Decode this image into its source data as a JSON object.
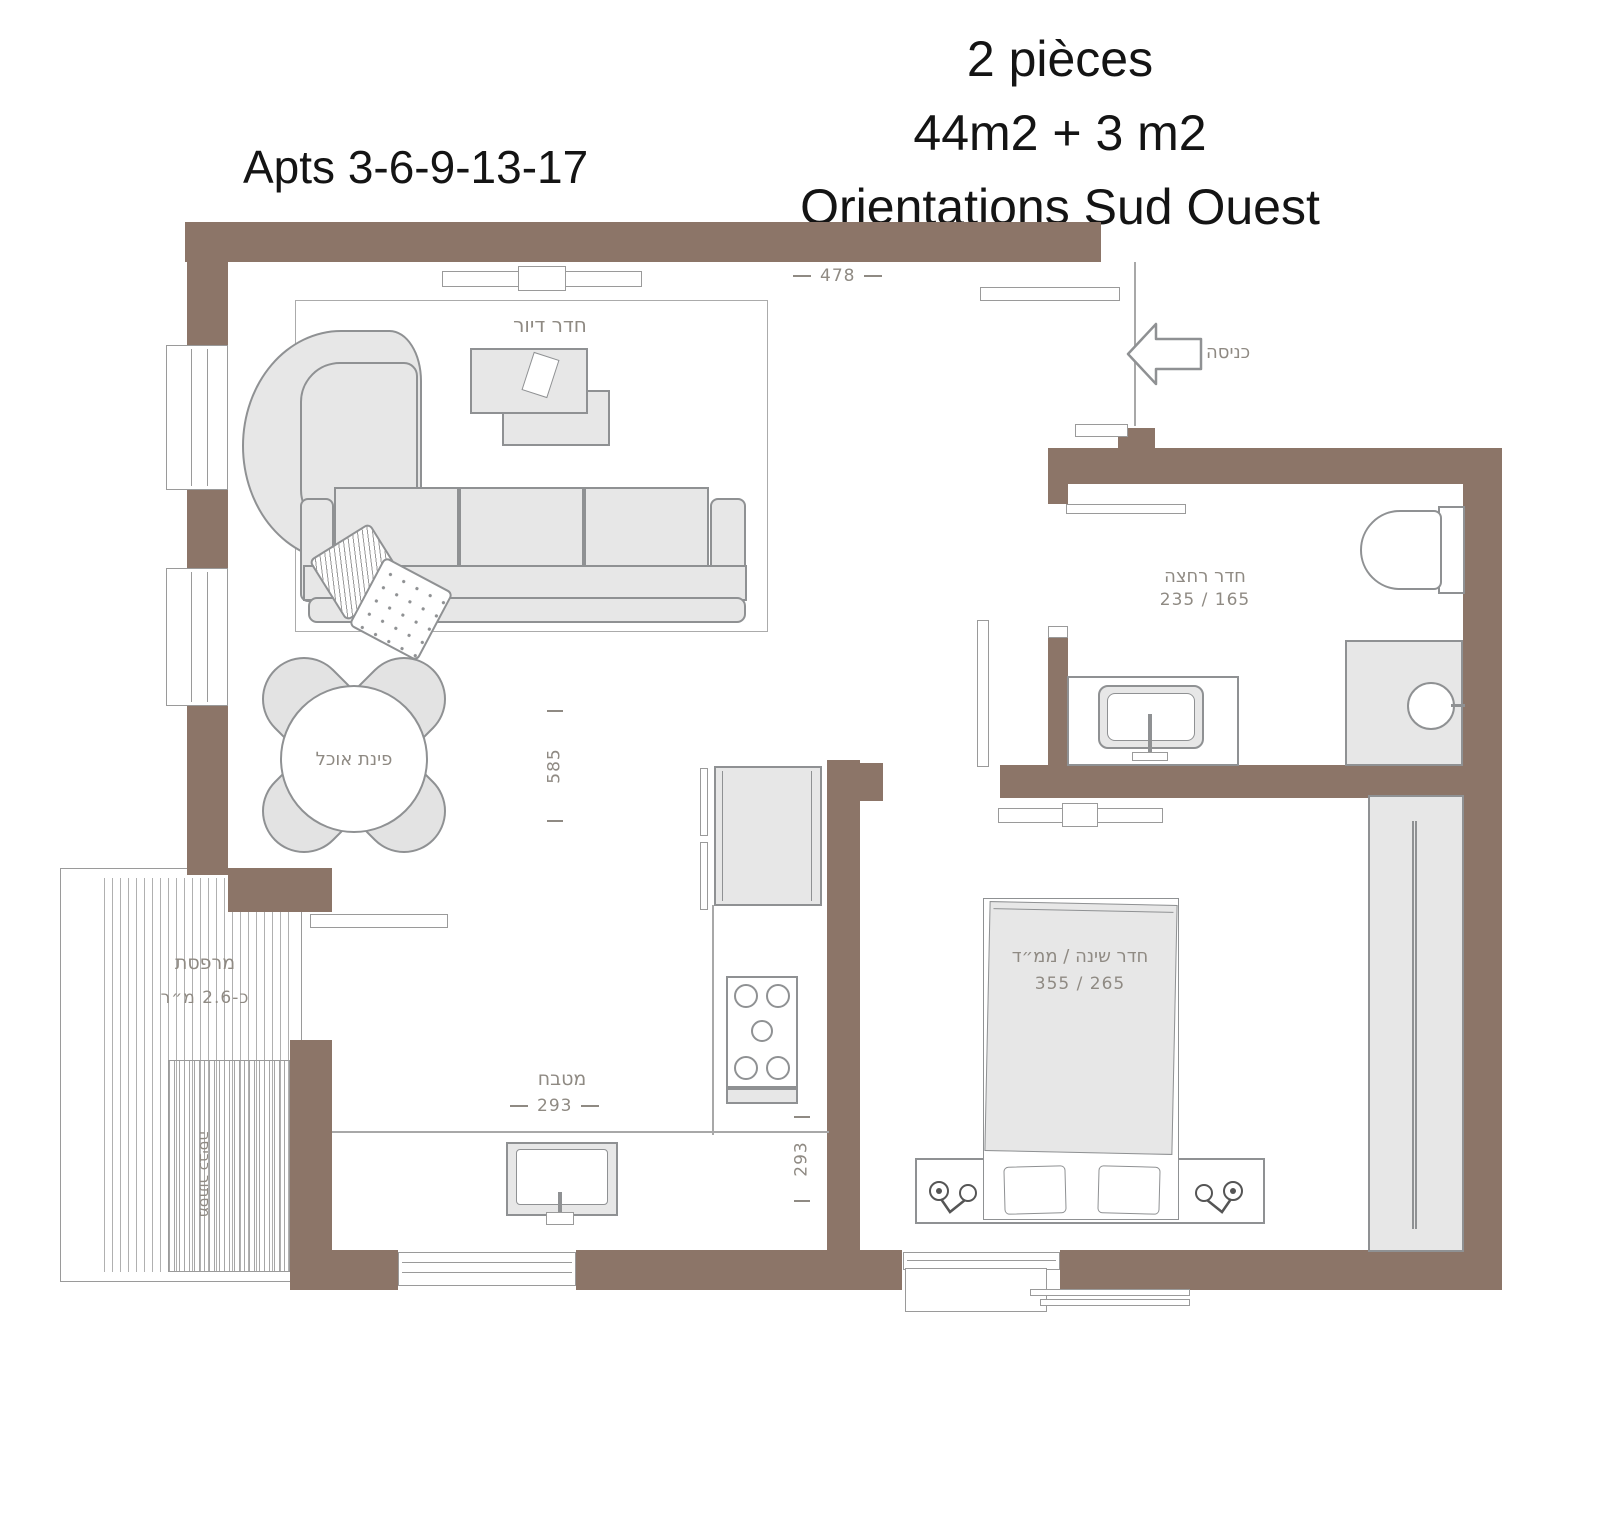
{
  "titles": {
    "apts": "Apts 3-6-9-13-17",
    "line1": "2 pièces",
    "line2": "44m2 + 3 m2",
    "line3": "Orientations Sud Ouest"
  },
  "rooms": {
    "living": "חדר דיור",
    "entrance": "כניסה",
    "bathroom": "חדר רחצה",
    "bathroom_dims": "235 / 165",
    "bedroom": "חדר שינה / ממ״ד",
    "bedroom_dims": "355 / 265",
    "kitchen": "מטבח",
    "dining": "פינת אוכל",
    "balcony": "מרפסת",
    "balcony_area": "כ-2.6 מ״ר",
    "laundry": "מסתור כביסה"
  },
  "dimensions": {
    "top_width": "478",
    "living_depth": "585",
    "kitchen_width": "293",
    "kitchen_depth": "293"
  },
  "colors": {
    "wall": "#8c7568",
    "furniture_fill": "#e7e7e7",
    "furniture_stroke": "#8f9193",
    "label": "#8f8a83",
    "title": "#141414",
    "background": "#ffffff"
  }
}
